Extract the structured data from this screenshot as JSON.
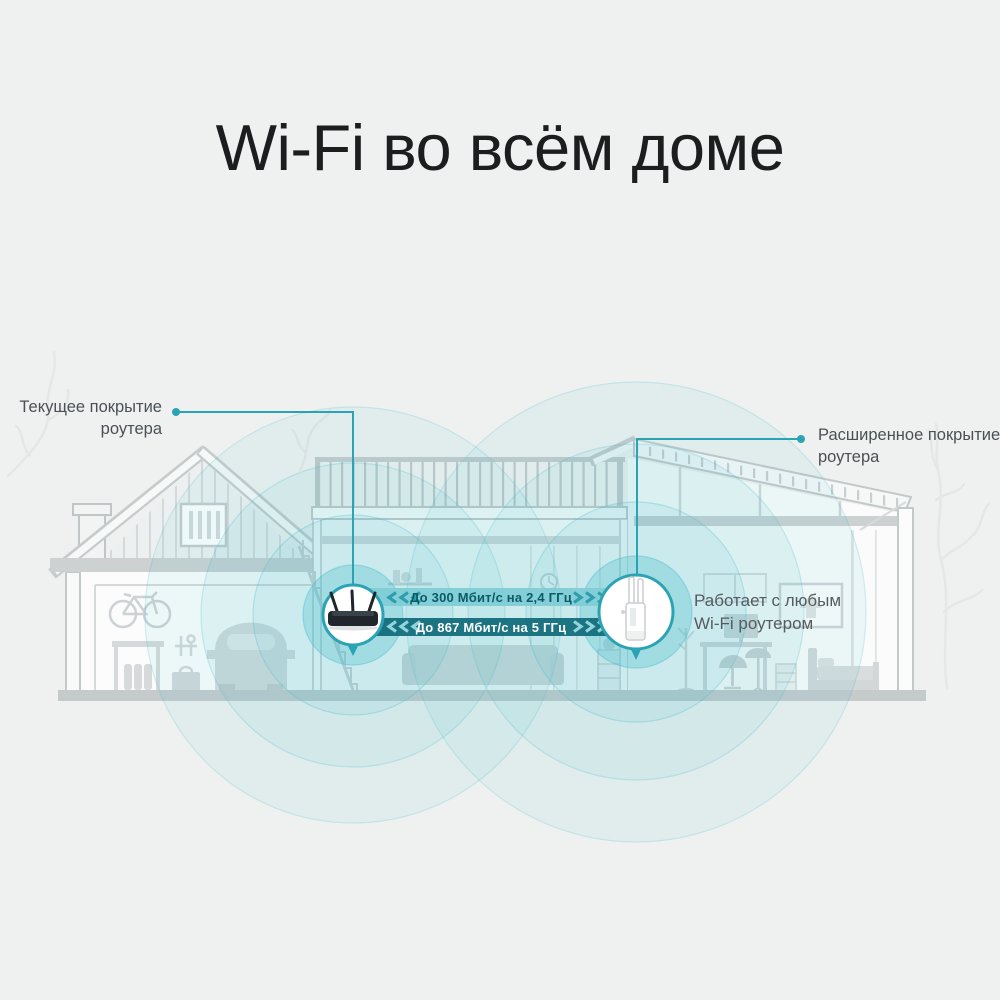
{
  "title": "Wi-Fi во всём доме",
  "callouts": {
    "left": {
      "line1": "Текущее покрытие",
      "line2": "роутера"
    },
    "right": {
      "line1": "Расширенное покрытие",
      "line2": "роутера"
    }
  },
  "speed_bands": {
    "band_24ghz": {
      "label": "До 300 Мбит/с на 2,4 ГГц"
    },
    "band_5ghz": {
      "label": "До 867 Мбит/с на 5 ГГц"
    }
  },
  "extender_note": {
    "line1": "Работает с любым",
    "line2": "Wi-Fi роутером"
  },
  "icons": {
    "router": "wifi-router-icon",
    "extender": "range-extender-icon"
  },
  "colors": {
    "background": "#EFF1F0",
    "accent_teal": "#2AA3B4",
    "wave_teal": "#45BCCD",
    "band_light": "#7FCCD6",
    "band_dark": "#17707E",
    "band_light_text": "#0B5A67",
    "band_dark_text": "#FFFFFF",
    "house_line": "#C3C8C9",
    "title_text": "#1C1D1F",
    "label_text": "#4A5054"
  }
}
